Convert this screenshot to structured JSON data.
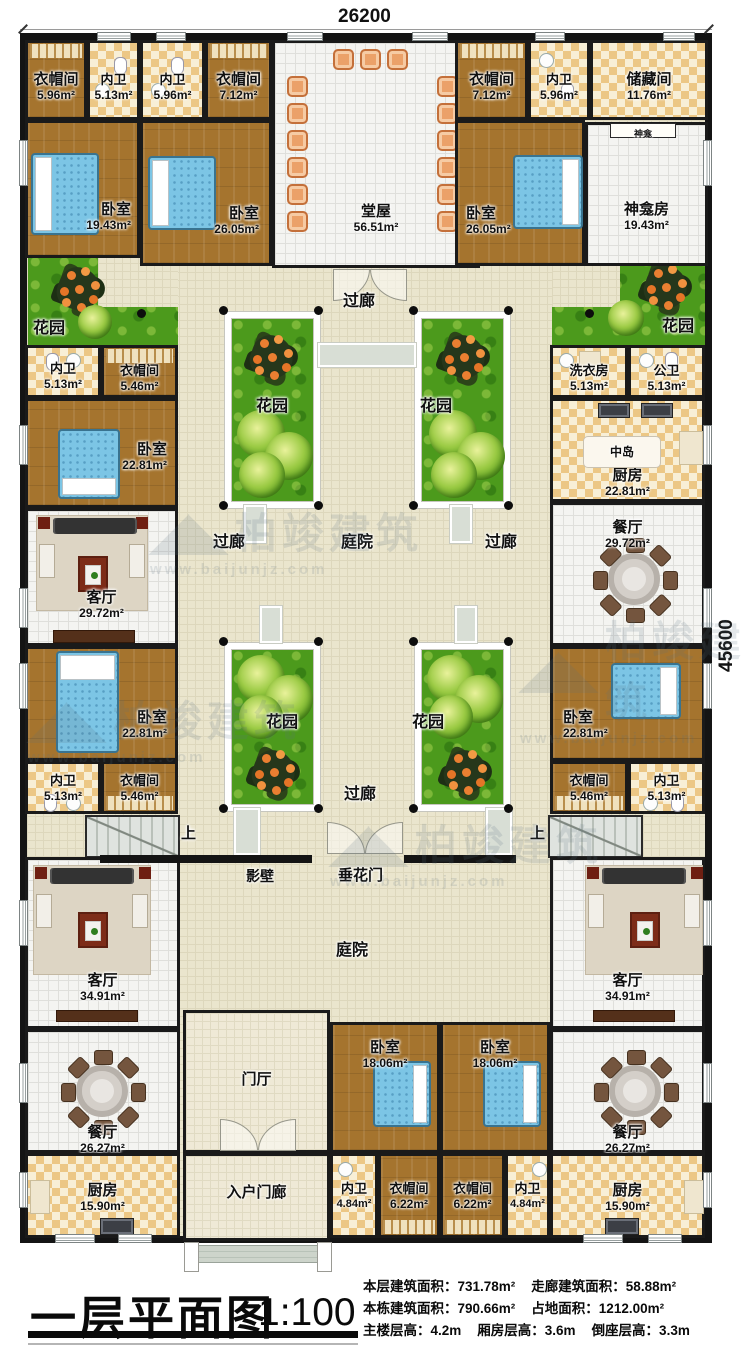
{
  "meta": {
    "top_dimension": "26200",
    "right_dimension": "45600",
    "watermark": {
      "name": "柏竣建筑",
      "logo": "◢◣",
      "url": "www.baijunjz.com"
    }
  },
  "title_block": {
    "title": "一层平面图",
    "scale": "1:100",
    "stats": [
      "本层建筑面积：731.78m²",
      "走廊建筑面积：58.88m²",
      "本栋建筑面积：790.66m²",
      "占地面积：1212.00m²",
      "主楼层高：4.2m",
      "厢房层高：3.6m",
      "倒座层高：3.3m"
    ]
  },
  "rooms": [
    {
      "n": "衣帽间",
      "a": "5.96m²"
    },
    {
      "n": "内卫",
      "a": "5.13m²"
    },
    {
      "n": "内卫",
      "a": "5.96m²"
    },
    {
      "n": "衣帽间",
      "a": "7.12m²"
    },
    {
      "n": "卧室",
      "a": "19.43m²"
    },
    {
      "n": "卧室",
      "a": "26.05m²"
    },
    {
      "n": "堂屋",
      "a": "56.51m²"
    },
    {
      "n": "衣帽间",
      "a": "7.12m²"
    },
    {
      "n": "内卫",
      "a": "5.96m²"
    },
    {
      "n": "储藏间",
      "a": "11.76m²"
    },
    {
      "n": "卧室",
      "a": "26.05m²"
    },
    {
      "n": "神龛房",
      "a": "19.43m²"
    },
    {
      "n": "内卫",
      "a": "5.13m²"
    },
    {
      "n": "衣帽间",
      "a": "5.46m²"
    },
    {
      "n": "卧室",
      "a": "22.81m²"
    },
    {
      "n": "客厅",
      "a": "29.72m²"
    },
    {
      "n": "洗衣房",
      "a": "5.13m²"
    },
    {
      "n": "公卫",
      "a": "5.13m²"
    },
    {
      "n": "厨房",
      "a": "22.81m²"
    },
    {
      "n": "餐厅",
      "a": "29.72m²"
    },
    {
      "n": "卧室",
      "a": "22.81m²"
    },
    {
      "n": "内卫",
      "a": "5.13m²"
    },
    {
      "n": "衣帽间",
      "a": "5.46m²"
    },
    {
      "n": "卧室",
      "a": "22.81m²"
    },
    {
      "n": "衣帽间",
      "a": "5.46m²"
    },
    {
      "n": "内卫",
      "a": "5.13m²"
    },
    {
      "n": "客厅",
      "a": "34.91m²"
    },
    {
      "n": "客厅",
      "a": "34.91m²"
    },
    {
      "n": "餐厅",
      "a": "26.27m²"
    },
    {
      "n": "餐厅",
      "a": "26.27m²"
    },
    {
      "n": "厨房",
      "a": "15.90m²"
    },
    {
      "n": "厨房",
      "a": "15.90m²"
    },
    {
      "n": "门厅",
      "a": ""
    },
    {
      "n": "入户门廊",
      "a": ""
    },
    {
      "n": "卧室",
      "a": "18.06m²"
    },
    {
      "n": "卧室",
      "a": "18.06m²"
    },
    {
      "n": "内卫",
      "a": "4.84m²"
    },
    {
      "n": "衣帽间",
      "a": "6.22m²"
    },
    {
      "n": "衣帽间",
      "a": "6.22m²"
    },
    {
      "n": "内卫",
      "a": "4.84m²"
    }
  ],
  "labels": [
    {
      "t": "过廊"
    },
    {
      "t": "过廊"
    },
    {
      "t": "庭院"
    },
    {
      "t": "过廊"
    },
    {
      "t": "过廊"
    },
    {
      "t": "庭院"
    },
    {
      "t": "花园"
    },
    {
      "t": "花园"
    },
    {
      "t": "花园"
    },
    {
      "t": "花园"
    },
    {
      "t": "花园"
    },
    {
      "t": "花园"
    },
    {
      "t": "上"
    },
    {
      "t": "上"
    },
    {
      "t": "影壁"
    },
    {
      "t": "垂花门"
    },
    {
      "t": "神龛"
    },
    {
      "t": "中岛"
    }
  ]
}
